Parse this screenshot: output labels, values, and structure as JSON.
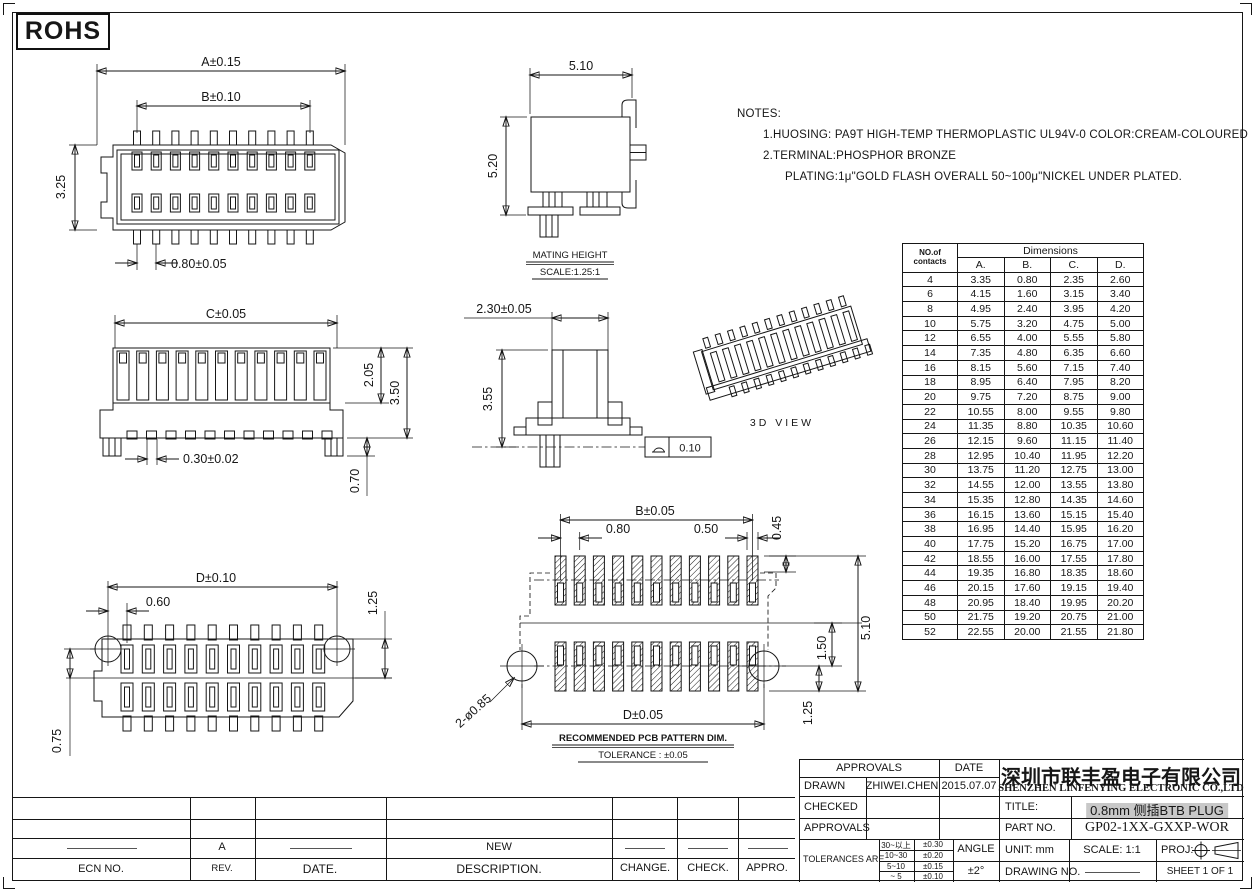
{
  "sheet": {
    "rohs": "ROHS"
  },
  "notes": {
    "heading": "NOTES:",
    "line1": "1.HUOSING: PA9T HIGH-TEMP THERMOPLASTIC UL94V-0 COLOR:CREAM-COLOURED",
    "line2": "2.TERMINAL:PHOSPHOR BRONZE",
    "line3": "PLATING:1μ\"GOLD FLASH OVERALL 50~100μ\"NICKEL UNDER PLATED."
  },
  "views": {
    "top": {
      "dim_a": "A±0.15",
      "dim_b": "B±0.10",
      "dim_height": "3.25",
      "dim_pitch": "0.80±0.05"
    },
    "mating": {
      "dim_width": "5.10",
      "dim_height": "5.20",
      "caption": "MATING HEIGHT",
      "scale": "SCALE:1.25:1"
    },
    "front": {
      "dim_c": "C±0.05",
      "dim_upper": "2.05",
      "dim_total": "3.50",
      "dim_pad": "0.30±0.02",
      "dim_foot": "0.70"
    },
    "side": {
      "dim_width": "2.30±0.05",
      "dim_height": "3.55",
      "flatness": "0.10"
    },
    "iso": {
      "caption": "3D  VIEW"
    },
    "bottom": {
      "dim_d": "D±0.10",
      "dim_offset": "0.60",
      "dim_left": "0.75",
      "dim_right": "1.25"
    },
    "pcb": {
      "dim_b": "B±0.05",
      "dim_pitch": "0.80",
      "dim_pad": "0.50",
      "dim_edge": "0.45",
      "dim_gap": "1.50",
      "dim_total": "5.10",
      "dim_hole": "1.25",
      "dim_d": "D±0.05",
      "holes": "2-ø0.85",
      "caption": "RECOMMENDED PCB PATTERN DIM.",
      "tolerance": "TOLERANCE : ±0.05"
    }
  },
  "dim_table": {
    "col_header_line1": "NO.of",
    "col_header_line2": "contacts",
    "group_header": "Dimensions",
    "columns": [
      "A.",
      "B.",
      "C.",
      "D."
    ],
    "rows": [
      [
        "4",
        "3.35",
        "0.80",
        "2.35",
        "2.60"
      ],
      [
        "6",
        "4.15",
        "1.60",
        "3.15",
        "3.40"
      ],
      [
        "8",
        "4.95",
        "2.40",
        "3.95",
        "4.20"
      ],
      [
        "10",
        "5.75",
        "3.20",
        "4.75",
        "5.00"
      ],
      [
        "12",
        "6.55",
        "4.00",
        "5.55",
        "5.80"
      ],
      [
        "14",
        "7.35",
        "4.80",
        "6.35",
        "6.60"
      ],
      [
        "16",
        "8.15",
        "5.60",
        "7.15",
        "7.40"
      ],
      [
        "18",
        "8.95",
        "6.40",
        "7.95",
        "8.20"
      ],
      [
        "20",
        "9.75",
        "7.20",
        "8.75",
        "9.00"
      ],
      [
        "22",
        "10.55",
        "8.00",
        "9.55",
        "9.80"
      ],
      [
        "24",
        "11.35",
        "8.80",
        "10.35",
        "10.60"
      ],
      [
        "26",
        "12.15",
        "9.60",
        "11.15",
        "11.40"
      ],
      [
        "28",
        "12.95",
        "10.40",
        "11.95",
        "12.20"
      ],
      [
        "30",
        "13.75",
        "11.20",
        "12.75",
        "13.00"
      ],
      [
        "32",
        "14.55",
        "12.00",
        "13.55",
        "13.80"
      ],
      [
        "34",
        "15.35",
        "12.80",
        "14.35",
        "14.60"
      ],
      [
        "36",
        "16.15",
        "13.60",
        "15.15",
        "15.40"
      ],
      [
        "38",
        "16.95",
        "14.40",
        "15.95",
        "16.20"
      ],
      [
        "40",
        "17.75",
        "15.20",
        "16.75",
        "17.00"
      ],
      [
        "42",
        "18.55",
        "16.00",
        "17.55",
        "17.80"
      ],
      [
        "44",
        "19.35",
        "16.80",
        "18.35",
        "18.60"
      ],
      [
        "46",
        "20.15",
        "17.60",
        "19.15",
        "19.40"
      ],
      [
        "48",
        "20.95",
        "18.40",
        "19.95",
        "20.20"
      ],
      [
        "50",
        "21.75",
        "19.20",
        "20.75",
        "21.00"
      ],
      [
        "52",
        "22.55",
        "20.00",
        "21.55",
        "21.80"
      ]
    ]
  },
  "revision": {
    "rev_value": "A",
    "description_value": "NEW",
    "ecn_label": "ECN  NO.",
    "rev_label": "REV.",
    "date_label": "DATE.",
    "description_label": "DESCRIPTION.",
    "change_label": "CHANGE.",
    "check_label": "CHECK.",
    "appro_label": "APPRO."
  },
  "title_block": {
    "approvals_label": "APPROVALS",
    "date_label": "DATE",
    "drawn_label": "DRAWN",
    "drawn_name": "ZHIWEI.CHEN",
    "drawn_date": "2015.07.07",
    "checked_label": "CHECKED",
    "approvals2_label": "APPROVALS",
    "tolerances_label": "TOLERANCES  ARE",
    "tolerance_rows": [
      [
        "30~以上",
        "±0.30"
      ],
      [
        "10~30",
        "±0.20"
      ],
      [
        "5~10",
        "±0.15"
      ],
      [
        "~ 5",
        "±0.10"
      ]
    ],
    "angle_label": "ANGLE",
    "angle_value": "±2°",
    "company_cn": "深圳市联丰盈电子有限公司",
    "company_en": "SHENZHEN LINFENYING ELECTRONIC CO.,LTD",
    "title_label": "TITLE:",
    "title_value": "0.8mm 侧插BTB PLUG",
    "part_label": "PART  NO.",
    "part_value": "GP02-1XX-GXXP-WOR",
    "unit_label": "UNIT:  mm",
    "scale_label": "SCALE:   1:1",
    "proj_label": "PROJ:",
    "drawing_label": "DRAWING  NO.",
    "sheet_label": "SHEET   1  OF  1"
  }
}
